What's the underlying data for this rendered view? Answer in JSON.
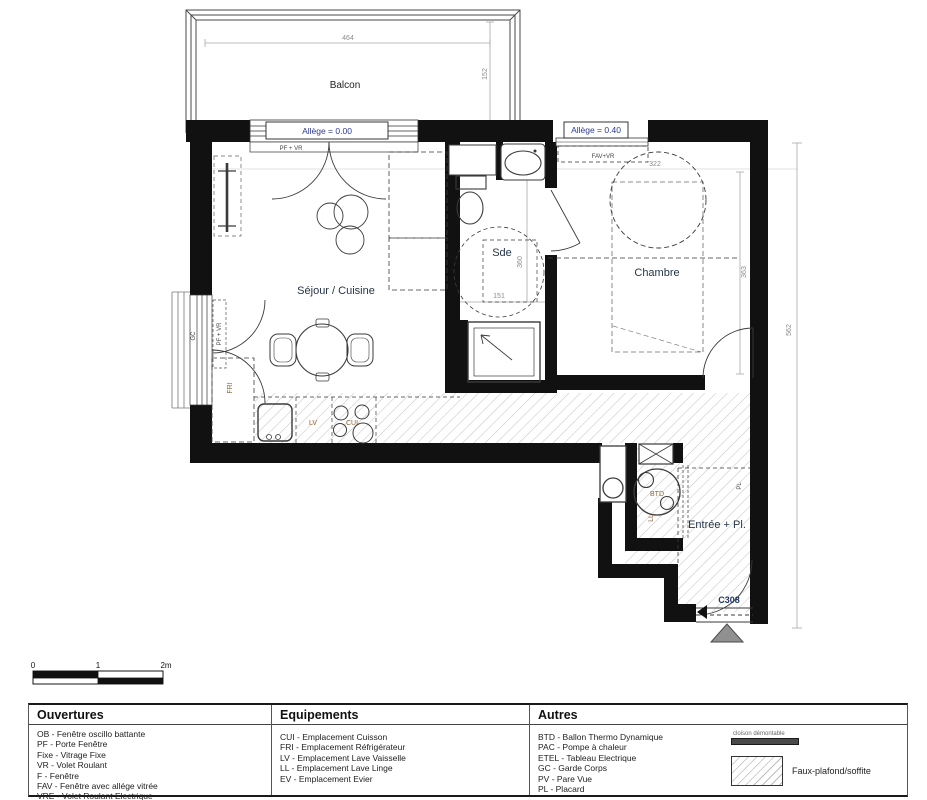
{
  "plan": {
    "unit": "C308",
    "rooms": {
      "balcon": "Balcon",
      "sejour": "Séjour / Cuisine",
      "sde": "Sde",
      "chambre": "Chambre",
      "entree": "Entrée + Pl."
    },
    "annotations": {
      "allege_0": "Allège = 0.00",
      "allege_40": "Allège = 0.40",
      "pf_vr": "PF + VR",
      "pf_vr_left": "PF + VR",
      "fav_vr": "FAV+VR",
      "gc": "GC",
      "pl": "PL"
    },
    "equipment": {
      "fri": "FRI",
      "lv": "LV",
      "cui": "CUI",
      "btd": "BTD",
      "ll": "LL"
    },
    "dims": {
      "d464": "464",
      "d152": "152",
      "d322": "322",
      "d363": "363",
      "d151": "151",
      "d360": "360",
      "d562": "562"
    },
    "scale": {
      "zero": "0",
      "one": "1",
      "two": "2m"
    }
  },
  "legend": {
    "ouvertures": {
      "title": "Ouvertures",
      "items": [
        "OB - Fenêtre oscillo battante",
        "PF - Porte Fenêtre",
        "Fixe - Vitrage Fixe",
        "VR - Volet Roulant",
        "F - Fenêtre",
        "FAV - Fenêtre avec allége vitrée",
        "VRE - Volet Roulant Electrique"
      ]
    },
    "equipements": {
      "title": "Equipements",
      "items": [
        "CUI - Emplacement Cuisson",
        "FRI - Emplacement Réfrigérateur",
        "LV - Emplacement Lave Vaisselle",
        "LL - Emplacement Lave Linge",
        "EV - Emplacement Evier"
      ]
    },
    "autres": {
      "title": "Autres",
      "items": [
        "BTD - Ballon Thermo Dynamique",
        "PAC - Pompe à chaleur",
        "ETEL - Tableau Electrique",
        "GC - Garde Corps",
        "PV - Pare Vue",
        "PL - Placard"
      ]
    },
    "symbols": {
      "cloison": "cloison démontable",
      "faux_plafond": "Faux-plafond/soffite"
    }
  },
  "colors": {
    "wall": "#111111",
    "accent_blue": "#2b3a8f",
    "room_label": "#243447",
    "equipment_label": "#8a6434",
    "dim_gray": "#8a8a8a",
    "triangle": "#909090"
  }
}
